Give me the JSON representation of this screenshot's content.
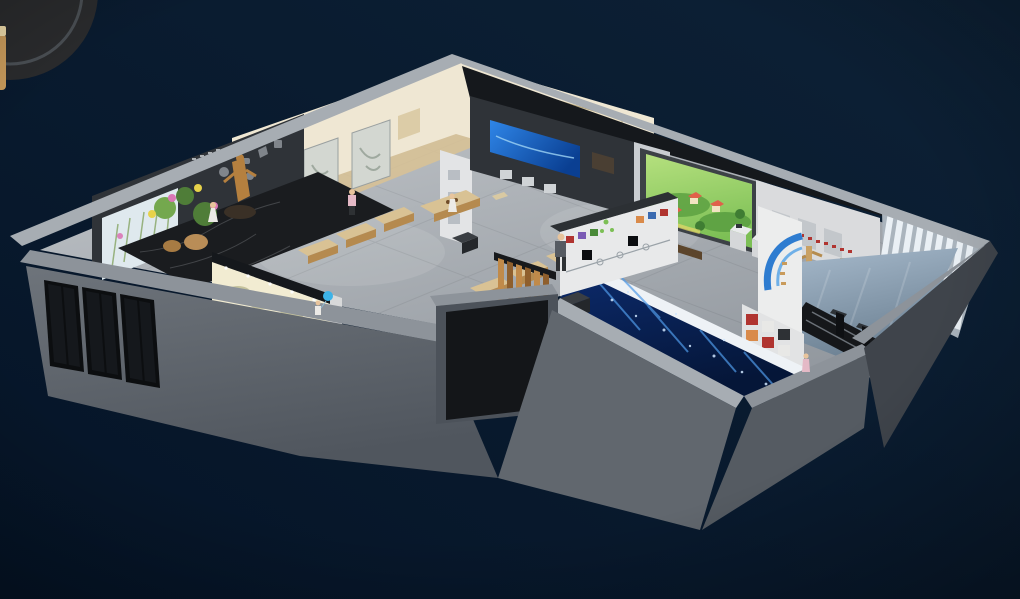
{
  "scene": {
    "type": "3d-isometric-cutaway-render",
    "subject": "exhibition-hall-floorplan",
    "people_visible": 6,
    "badge": {
      "position": "top-left-corner",
      "style": "dark circular emblem with gold detail, cropped by image edge"
    },
    "rooms": [
      {
        "id": "tea-classroom",
        "features": [
          "cream walls with wood lattice",
          "ink paintings",
          "calligraphy plaque",
          "lotus mural board",
          "six low wooden tables",
          "teacher desk"
        ]
      },
      {
        "id": "specimen-gallery",
        "features": [
          "dark artifact wall",
          "backlit plant specimen lightbox",
          "black marble floor",
          "flower baskets",
          "gilded statue",
          "glass entry doors"
        ]
      },
      {
        "id": "corridor",
        "features": [
          "backlit scroll mural",
          "black counter",
          "child with balloon"
        ]
      },
      {
        "id": "media-hall",
        "features": [
          "dark media wall with blue screen",
          "display pedestals",
          "poster wall",
          "timeline exhibit wall",
          "wood slat partition"
        ]
      },
      {
        "id": "projection-room",
        "features": [
          "large green cartoon projection screen",
          "bench",
          "display cabinet",
          "white kiosks"
        ]
      },
      {
        "id": "immersive-room",
        "features": [
          "deep blue LED wall with light streaks",
          "white lit edge"
        ]
      },
      {
        "id": "lobby",
        "features": [
          "louvered bright window wall",
          "curved blue ring mural",
          "photo grid wall",
          "two turnstile gates",
          "reflective floor",
          "ramp"
        ]
      },
      {
        "id": "martial-arts-wall",
        "features": [
          "white wall with red calligraphy",
          "two wooden training dummies",
          "dark display cabinet",
          "white kiosks"
        ]
      }
    ],
    "text_note": "all in-scene writing is decorative chinese calligraphy, illegible at this resolution"
  },
  "palette": {
    "bg_top": "#0d2136",
    "bg_bottom": "#051427",
    "badge_circle": "#2a2b2d",
    "badge_ring": "#4a4f54",
    "badge_gold": "#c99b5b",
    "badge_gold_light": "#ecd9a8",
    "wall_cap": "#a7adb3",
    "wall_cap_dark": "#8d939a",
    "front_light": "#6e747b",
    "front_dark": "#50565e",
    "wall_front": "#61676e",
    "wall_front_dark": "#4c525a",
    "wall_side": "#555b62",
    "wall_shadow": "#3f444b",
    "floor_light": "#c2c6ca",
    "floor_dark": "#8f959c",
    "floor_wood": "#d9c294",
    "cream_wall": "#efe7d3",
    "lattice": "#d9c9a2",
    "lattice_dark": "#c3b183",
    "ink_painting": "#d3d7d1",
    "dark_wall": "#2f3338",
    "dark_wall2": "#26292e",
    "ceiling_dark": "#15181c",
    "lightbox": "#dfe9ee",
    "marble_black": "#1a1c1f",
    "mural_glow": "#f2ecd2",
    "mural_green": "#a8a87a",
    "wood_slat": "#c08a4a",
    "wood_slat_dark": "#8f5f2d",
    "screen_blue_1": "#2f86e8",
    "screen_blue_2": "#0a3f92",
    "green_light": "#b5e07e",
    "green_screen": "#7cbf55",
    "green_hill": "#5fa344",
    "tree_green": "#3f7d33",
    "house_red": "#e0604a",
    "immersive_blue": "#0c2a6b",
    "immersive_blue_dark": "#051638",
    "immersive_streak": "#4f9ae8",
    "louver_bright": "#eef4f9",
    "louver_shade": "#aab4bd",
    "lobby_floor": "#a3b6c8",
    "lobby_floor_dark": "#5f7486",
    "mural_blue": "#2e7cd0",
    "mural_blue_light": "#6fb0e8",
    "photo_red": "#b03430",
    "photo_orange": "#d98a4a",
    "photo_dark": "#2e3135",
    "photo_light": "#e8e8e6",
    "kiosk_white": "#e9ebec",
    "kiosk_face": "#d5d7d9",
    "timeline_white": "#e8e9ea",
    "screen_black": "#0b0d10",
    "statue_gold": "#b5803f",
    "plant_green": "#4f7d38",
    "plant_green2": "#74a84e",
    "flower_pink": "#d977b5",
    "flower_yellow": "#e7d24a",
    "basket_tan": "#b98d57",
    "glass_dark": "#15181c",
    "door_frame": "#0c0e10",
    "bench_brown": "#5c452c",
    "desk_black": "#141618",
    "person_skin": "#e8c49c",
    "person_white": "#eceae6",
    "person_gray": "#565b62",
    "person_dark": "#2e3134",
    "person_pink": "#e4b9c6",
    "balloon_blue": "#3db3e8"
  }
}
